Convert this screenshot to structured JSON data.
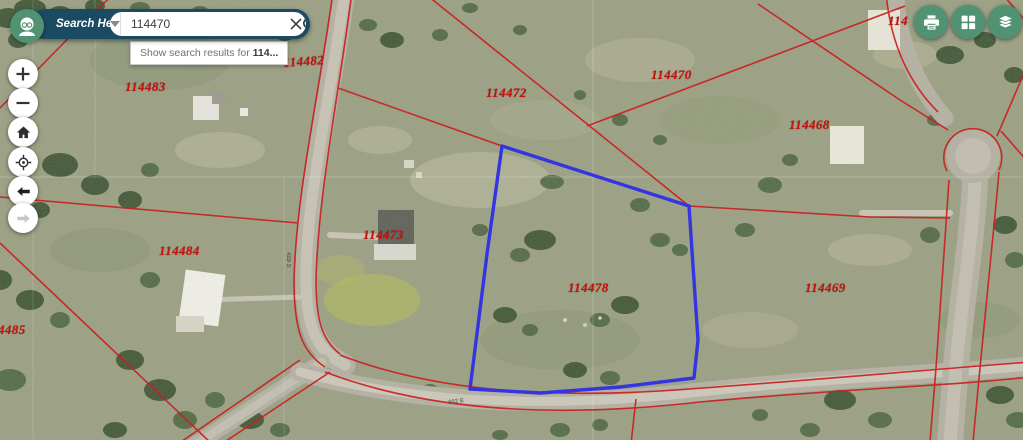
{
  "search": {
    "label": "Search Here:",
    "value": "114470",
    "suggestion": {
      "prefix": "Show search results for ",
      "term": "114..."
    }
  },
  "controls": {
    "left": [
      "zoom-in",
      "zoom-out",
      "home",
      "my-location",
      "back",
      "forward"
    ],
    "top_right": [
      "print",
      "basemap-gallery",
      "layers"
    ]
  },
  "map": {
    "selected_parcel": {
      "id": "114478",
      "outline_color": "#3434e0"
    },
    "parcel_line_color": "#c92020",
    "parcel_labels": [
      {
        "text": "114482",
        "x": 283,
        "y": 55,
        "rot": -4
      },
      {
        "text": "114483",
        "x": 125,
        "y": 79,
        "rot": 0
      },
      {
        "text": "114472",
        "x": 486,
        "y": 85,
        "rot": 0
      },
      {
        "text": "114470",
        "x": 651,
        "y": 67,
        "rot": 0
      },
      {
        "text": "114468",
        "x": 789,
        "y": 117,
        "rot": 0
      },
      {
        "text": "114484",
        "x": 159,
        "y": 243,
        "rot": 0
      },
      {
        "text": "114473",
        "x": 363,
        "y": 227,
        "rot": 0
      },
      {
        "text": "114478",
        "x": 568,
        "y": 280,
        "rot": 0
      },
      {
        "text": "114469",
        "x": 805,
        "y": 280,
        "rot": 0
      },
      {
        "text": "4485",
        "x": -2,
        "y": 322,
        "rot": 0
      },
      {
        "text": "114",
        "x": 888,
        "y": 13,
        "rot": 0
      }
    ],
    "road_labels": [
      {
        "text": "429 S",
        "x": 291,
        "y": 252,
        "rot": 90
      },
      {
        "text": "602 E",
        "x": 448,
        "y": 400,
        "rot": -7
      }
    ]
  }
}
